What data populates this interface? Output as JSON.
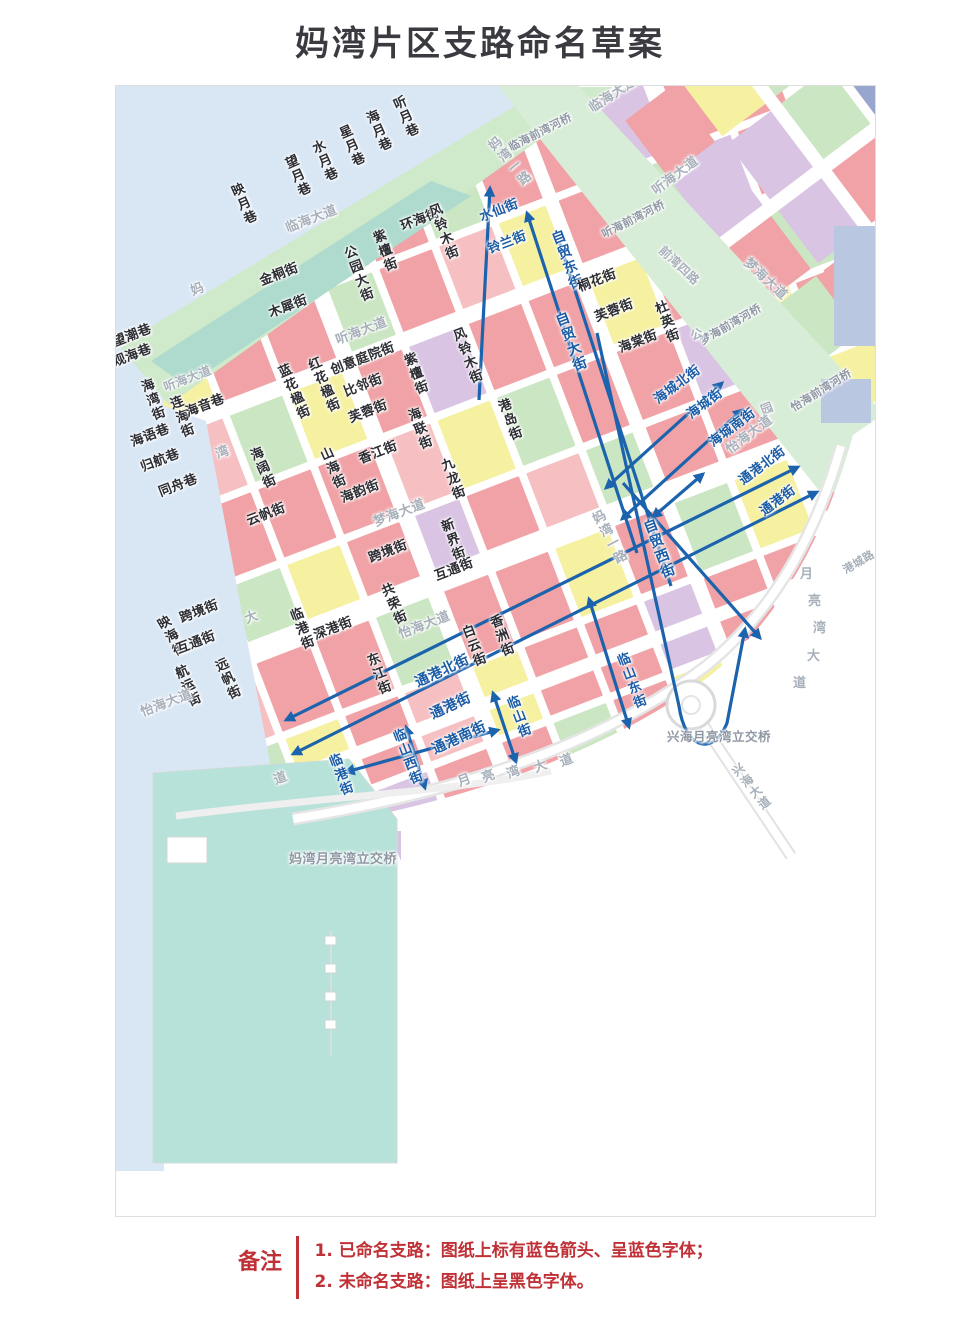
{
  "title": "妈湾片区支路命名草案",
  "note": {
    "label": "备注",
    "lines": [
      "1. 已命名支路：图纸上标有蓝色箭头、呈蓝色字体；",
      "2. 未命名支路：图纸上呈黑色字体。"
    ],
    "color": "#c03137"
  },
  "palette": {
    "p": "#f0a2a6",
    "P": "#f6c0c2",
    "y": "#f6f1a1",
    "g": "#cbe6c2",
    "l": "#d9c4e3",
    "t": "#a9ddd2",
    "s": "#98a6cf",
    "sea": "#d9e7f5",
    "coast": "#cfe9cb",
    "coast_teal": "#aedbcd",
    "river": "#d8edd8",
    "harbor": "#bac7e0",
    "reclaimed": "#b6e2d9",
    "road_edge": "#e5e5e5",
    "arrow_blue": "#1c63ad",
    "named_street_text": "#1b5ca6",
    "unnamed_street_text": "#2c2d33",
    "avenue_text": "#a7b0ba",
    "landmark_text": "#8f97a4"
  },
  "map": {
    "labels": [
      {
        "t": "听月巷",
        "x": 388,
        "y": 99,
        "c": "b",
        "v": 1,
        "r": -24
      },
      {
        "t": "海月巷",
        "x": 361,
        "y": 113,
        "c": "b",
        "v": 1,
        "r": -24
      },
      {
        "t": "星月巷",
        "x": 334,
        "y": 128,
        "c": "b",
        "v": 1,
        "r": -24
      },
      {
        "t": "水月巷",
        "x": 307,
        "y": 143,
        "c": "b",
        "v": 1,
        "r": -24
      },
      {
        "t": "望月巷",
        "x": 280,
        "y": 158,
        "c": "b",
        "v": 1,
        "r": -24
      },
      {
        "t": "映月巷",
        "x": 226,
        "y": 186,
        "c": "b",
        "v": 1,
        "r": -24
      },
      {
        "t": "环海街",
        "x": 398,
        "y": 220,
        "c": "b"
      },
      {
        "t": "临海大道",
        "x": 283,
        "y": 222,
        "c": "f"
      },
      {
        "t": "临海大道",
        "x": 586,
        "y": 103,
        "c": "f",
        "r": -33
      },
      {
        "t": "妈湾一路",
        "x": 483,
        "y": 143,
        "c": "f",
        "v": 1,
        "r": -40
      },
      {
        "t": "妈湾一路",
        "x": 587,
        "y": 514,
        "c": "f",
        "v": 1,
        "r": -28
      },
      {
        "t": "临海前湾河桥",
        "x": 506,
        "y": 142,
        "c": "g",
        "r": -27,
        "s": 11
      },
      {
        "t": "风铃木街",
        "x": 424,
        "y": 206,
        "c": "b",
        "v": 1
      },
      {
        "t": "紫檀街",
        "x": 368,
        "y": 232,
        "c": "b",
        "v": 1
      },
      {
        "t": "公园大街",
        "x": 339,
        "y": 248,
        "c": "b",
        "v": 1
      },
      {
        "t": "金桐街",
        "x": 257,
        "y": 275,
        "c": "b"
      },
      {
        "t": "木犀街",
        "x": 266,
        "y": 307,
        "c": "b"
      },
      {
        "t": "听海大道",
        "x": 333,
        "y": 334,
        "c": "f"
      },
      {
        "t": "水仙街",
        "x": 477,
        "y": 211,
        "c": "u"
      },
      {
        "t": "铃兰街",
        "x": 485,
        "y": 243,
        "c": "u"
      },
      {
        "t": "自贸东街",
        "x": 547,
        "y": 232,
        "c": "u",
        "v": 1,
        "s": 14
      },
      {
        "t": "桐花街",
        "x": 575,
        "y": 281,
        "c": "b"
      },
      {
        "t": "芙蓉街",
        "x": 592,
        "y": 311,
        "c": "b"
      },
      {
        "t": "杜英街",
        "x": 650,
        "y": 303,
        "c": "b",
        "v": 1
      },
      {
        "t": "海棠街",
        "x": 616,
        "y": 342,
        "c": "b"
      },
      {
        "t": "自贸大街",
        "x": 551,
        "y": 314,
        "c": "u",
        "v": 1,
        "s": 14
      },
      {
        "t": "听海前湾河桥",
        "x": 599,
        "y": 229,
        "c": "g",
        "r": -27,
        "s": 11
      },
      {
        "t": "听海大道",
        "x": 649,
        "y": 186,
        "c": "f",
        "r": -37
      },
      {
        "t": "前湾四路",
        "x": 664,
        "y": 243,
        "c": "f",
        "r": 43,
        "s": 12
      },
      {
        "t": "梦海大道",
        "x": 749,
        "y": 255,
        "c": "f",
        "r": 43
      },
      {
        "t": "梦海前湾河桥",
        "x": 697,
        "y": 336,
        "c": "g",
        "r": -30,
        "s": 11
      },
      {
        "t": "怡海前湾河桥",
        "x": 788,
        "y": 403,
        "c": "g",
        "r": -32,
        "s": 11
      },
      {
        "t": "公",
        "x": 688,
        "y": 330,
        "c": "f",
        "s": 12
      },
      {
        "t": "园",
        "x": 758,
        "y": 404,
        "c": "f",
        "s": 12
      },
      {
        "t": "望潮巷",
        "x": 110,
        "y": 336,
        "c": "b"
      },
      {
        "t": "观海巷",
        "x": 110,
        "y": 356,
        "c": "b"
      },
      {
        "t": "海湾街",
        "x": 136,
        "y": 381,
        "c": "b",
        "v": 1
      },
      {
        "t": "连海街",
        "x": 165,
        "y": 398,
        "c": "b",
        "v": 1
      },
      {
        "t": "海音巷",
        "x": 183,
        "y": 406,
        "c": "b"
      },
      {
        "t": "海语巷",
        "x": 128,
        "y": 436,
        "c": "b"
      },
      {
        "t": "归航巷",
        "x": 138,
        "y": 461,
        "c": "b"
      },
      {
        "t": "同舟巷",
        "x": 156,
        "y": 486,
        "c": "b"
      },
      {
        "t": "听海大道",
        "x": 161,
        "y": 381,
        "c": "f",
        "s": 12
      },
      {
        "t": "妈",
        "x": 188,
        "y": 285,
        "c": "f"
      },
      {
        "t": "湾",
        "x": 213,
        "y": 448,
        "c": "f"
      },
      {
        "t": "大",
        "x": 242,
        "y": 613,
        "c": "f"
      },
      {
        "t": "道",
        "x": 271,
        "y": 774,
        "c": "f"
      },
      {
        "t": "蓝花楹街",
        "x": 273,
        "y": 367,
        "c": "b",
        "v": 1,
        "r": -24
      },
      {
        "t": "红花楹街",
        "x": 303,
        "y": 360,
        "c": "b",
        "v": 1,
        "r": -24
      },
      {
        "t": "创意庭院街",
        "x": 328,
        "y": 364,
        "c": "b"
      },
      {
        "t": "比邻街",
        "x": 341,
        "y": 386,
        "c": "b"
      },
      {
        "t": "紫檀街",
        "x": 399,
        "y": 355,
        "c": "b",
        "v": 1
      },
      {
        "t": "风铃木街",
        "x": 448,
        "y": 330,
        "c": "b",
        "v": 1
      },
      {
        "t": "芙蓉街",
        "x": 346,
        "y": 412,
        "c": "b"
      },
      {
        "t": "海联街",
        "x": 403,
        "y": 410,
        "c": "b",
        "v": 1
      },
      {
        "t": "港岛街",
        "x": 493,
        "y": 401,
        "c": "b",
        "v": 1
      },
      {
        "t": "山海街",
        "x": 315,
        "y": 450,
        "c": "b",
        "v": 1,
        "r": -24
      },
      {
        "t": "香江街",
        "x": 356,
        "y": 453,
        "c": "b"
      },
      {
        "t": "海韵街",
        "x": 338,
        "y": 492,
        "c": "b"
      },
      {
        "t": "九龙街",
        "x": 436,
        "y": 460,
        "c": "b",
        "v": 1
      },
      {
        "t": "海阔街",
        "x": 245,
        "y": 450,
        "c": "b",
        "v": 1,
        "r": -24
      },
      {
        "t": "云帆街",
        "x": 244,
        "y": 515,
        "c": "b"
      },
      {
        "t": "梦海大道",
        "x": 371,
        "y": 516,
        "c": "f"
      },
      {
        "t": "新界街",
        "x": 436,
        "y": 521,
        "c": "b",
        "v": 1
      },
      {
        "t": "跨境街",
        "x": 366,
        "y": 552,
        "c": "b"
      },
      {
        "t": "互通街",
        "x": 432,
        "y": 570,
        "c": "b"
      },
      {
        "t": "共荣街",
        "x": 376,
        "y": 586,
        "c": "b",
        "v": 1,
        "r": -24
      },
      {
        "t": "怡海大道",
        "x": 396,
        "y": 628,
        "c": "f"
      },
      {
        "t": "白云街",
        "x": 457,
        "y": 627,
        "c": "b",
        "v": 1
      },
      {
        "t": "香洲街",
        "x": 485,
        "y": 617,
        "c": "b",
        "v": 1
      },
      {
        "t": "映海街",
        "x": 152,
        "y": 620,
        "c": "b",
        "v": 1,
        "r": -30
      },
      {
        "t": "跨境街",
        "x": 177,
        "y": 612,
        "c": "b"
      },
      {
        "t": "互通街",
        "x": 174,
        "y": 643,
        "c": "b"
      },
      {
        "t": "航运街",
        "x": 170,
        "y": 668,
        "c": "b",
        "v": 1,
        "r": -24
      },
      {
        "t": "远帆街",
        "x": 210,
        "y": 661,
        "c": "b",
        "v": 1,
        "r": -24
      },
      {
        "t": "怡海大道",
        "x": 138,
        "y": 706,
        "c": "f"
      },
      {
        "t": "临港街",
        "x": 285,
        "y": 610,
        "c": "b",
        "v": 1
      },
      {
        "t": "深港街",
        "x": 311,
        "y": 629,
        "c": "b"
      },
      {
        "t": "东江街",
        "x": 362,
        "y": 655,
        "c": "b",
        "v": 1
      },
      {
        "t": "自贸西街",
        "x": 639,
        "y": 521,
        "c": "u",
        "v": 1,
        "s": 14
      },
      {
        "t": "临山东街",
        "x": 612,
        "y": 655,
        "c": "u",
        "v": 1
      },
      {
        "t": "临山街",
        "x": 502,
        "y": 698,
        "c": "u",
        "v": 1
      },
      {
        "t": "临山西街",
        "x": 388,
        "y": 731,
        "c": "u",
        "v": 1
      },
      {
        "t": "临港街",
        "x": 324,
        "y": 756,
        "c": "u",
        "v": 1
      },
      {
        "t": "通港北街",
        "x": 412,
        "y": 676,
        "c": "u",
        "r": -25,
        "s": 14
      },
      {
        "t": "通港街",
        "x": 427,
        "y": 708,
        "c": "u",
        "r": -25,
        "s": 14
      },
      {
        "t": "通港南街",
        "x": 429,
        "y": 743,
        "c": "u",
        "r": -25,
        "s": 14
      },
      {
        "t": "通港北街",
        "x": 736,
        "y": 476,
        "c": "u",
        "r": -37
      },
      {
        "t": "通港街",
        "x": 757,
        "y": 507,
        "c": "u",
        "r": -37
      },
      {
        "t": "海城北街",
        "x": 651,
        "y": 395,
        "c": "u",
        "r": -37
      },
      {
        "t": "海城街",
        "x": 684,
        "y": 410,
        "c": "u",
        "r": -37
      },
      {
        "t": "海城南街",
        "x": 706,
        "y": 438,
        "c": "u",
        "r": -37
      },
      {
        "t": "怡海大道",
        "x": 723,
        "y": 445,
        "c": "f",
        "r": -37
      },
      {
        "t": "港城路",
        "x": 840,
        "y": 565,
        "c": "f",
        "r": -30,
        "s": 11
      },
      {
        "t": "月",
        "x": 455,
        "y": 776,
        "c": "f"
      },
      {
        "t": "亮",
        "x": 479,
        "y": 772,
        "c": "f"
      },
      {
        "t": "湾",
        "x": 504,
        "y": 768,
        "c": "f"
      },
      {
        "t": "大",
        "x": 531,
        "y": 762,
        "c": "f"
      },
      {
        "t": "道",
        "x": 557,
        "y": 756,
        "c": "f"
      },
      {
        "t": "月",
        "x": 799,
        "y": 567,
        "c": "f",
        "r": 0
      },
      {
        "t": "亮",
        "x": 807,
        "y": 594,
        "c": "f",
        "r": 0
      },
      {
        "t": "湾",
        "x": 812,
        "y": 621,
        "c": "f",
        "r": 0
      },
      {
        "t": "大",
        "x": 806,
        "y": 649,
        "c": "f",
        "r": 0
      },
      {
        "t": "道",
        "x": 792,
        "y": 676,
        "c": "f",
        "r": 0
      },
      {
        "t": "兴海月亮湾立交桥",
        "x": 666,
        "y": 729,
        "c": "g",
        "r": 0,
        "s": 12.5
      },
      {
        "t": "妈湾月亮湾立交桥",
        "x": 288,
        "y": 852,
        "c": "g",
        "r": 0,
        "s": 13
      },
      {
        "t": "兴海大道",
        "x": 728,
        "y": 768,
        "c": "f",
        "v": 1,
        "r": -38,
        "s": 12
      }
    ],
    "arrows": [
      {
        "x1": 478,
        "y1": 399,
        "x2": 489,
        "y2": 187,
        "h": "e"
      },
      {
        "x1": 636,
        "y1": 552,
        "x2": 526,
        "y2": 212,
        "h": "e"
      },
      {
        "x1": 558,
        "y1": 240,
        "x2": 670,
        "y2": 585,
        "h": "n"
      },
      {
        "x1": 588,
        "y1": 598,
        "x2": 628,
        "y2": 726,
        "h": "b"
      },
      {
        "x1": 492,
        "y1": 692,
        "x2": 515,
        "y2": 761,
        "h": "b"
      },
      {
        "x1": 405,
        "y1": 726,
        "x2": 424,
        "y2": 787,
        "h": "b"
      },
      {
        "x1": 285,
        "y1": 719,
        "x2": 797,
        "y2": 466,
        "h": "b"
      },
      {
        "x1": 292,
        "y1": 753,
        "x2": 816,
        "y2": 491,
        "h": "b"
      },
      {
        "x1": 345,
        "y1": 771,
        "x2": 497,
        "y2": 729,
        "h": "b"
      },
      {
        "x1": 605,
        "y1": 487,
        "x2": 721,
        "y2": 382,
        "h": "b"
      },
      {
        "x1": 621,
        "y1": 518,
        "x2": 741,
        "y2": 409,
        "h": "b"
      },
      {
        "x1": 652,
        "y1": 516,
        "x2": 702,
        "y2": 473,
        "h": "b"
      },
      {
        "x1": 622,
        "y1": 482,
        "x2": 759,
        "y2": 637,
        "h": "e"
      }
    ],
    "arrow_paths": [
      {
        "d": "M596,332 L678,705 C684,748 712,756 726,722 L744,628",
        "h": "e"
      }
    ]
  }
}
